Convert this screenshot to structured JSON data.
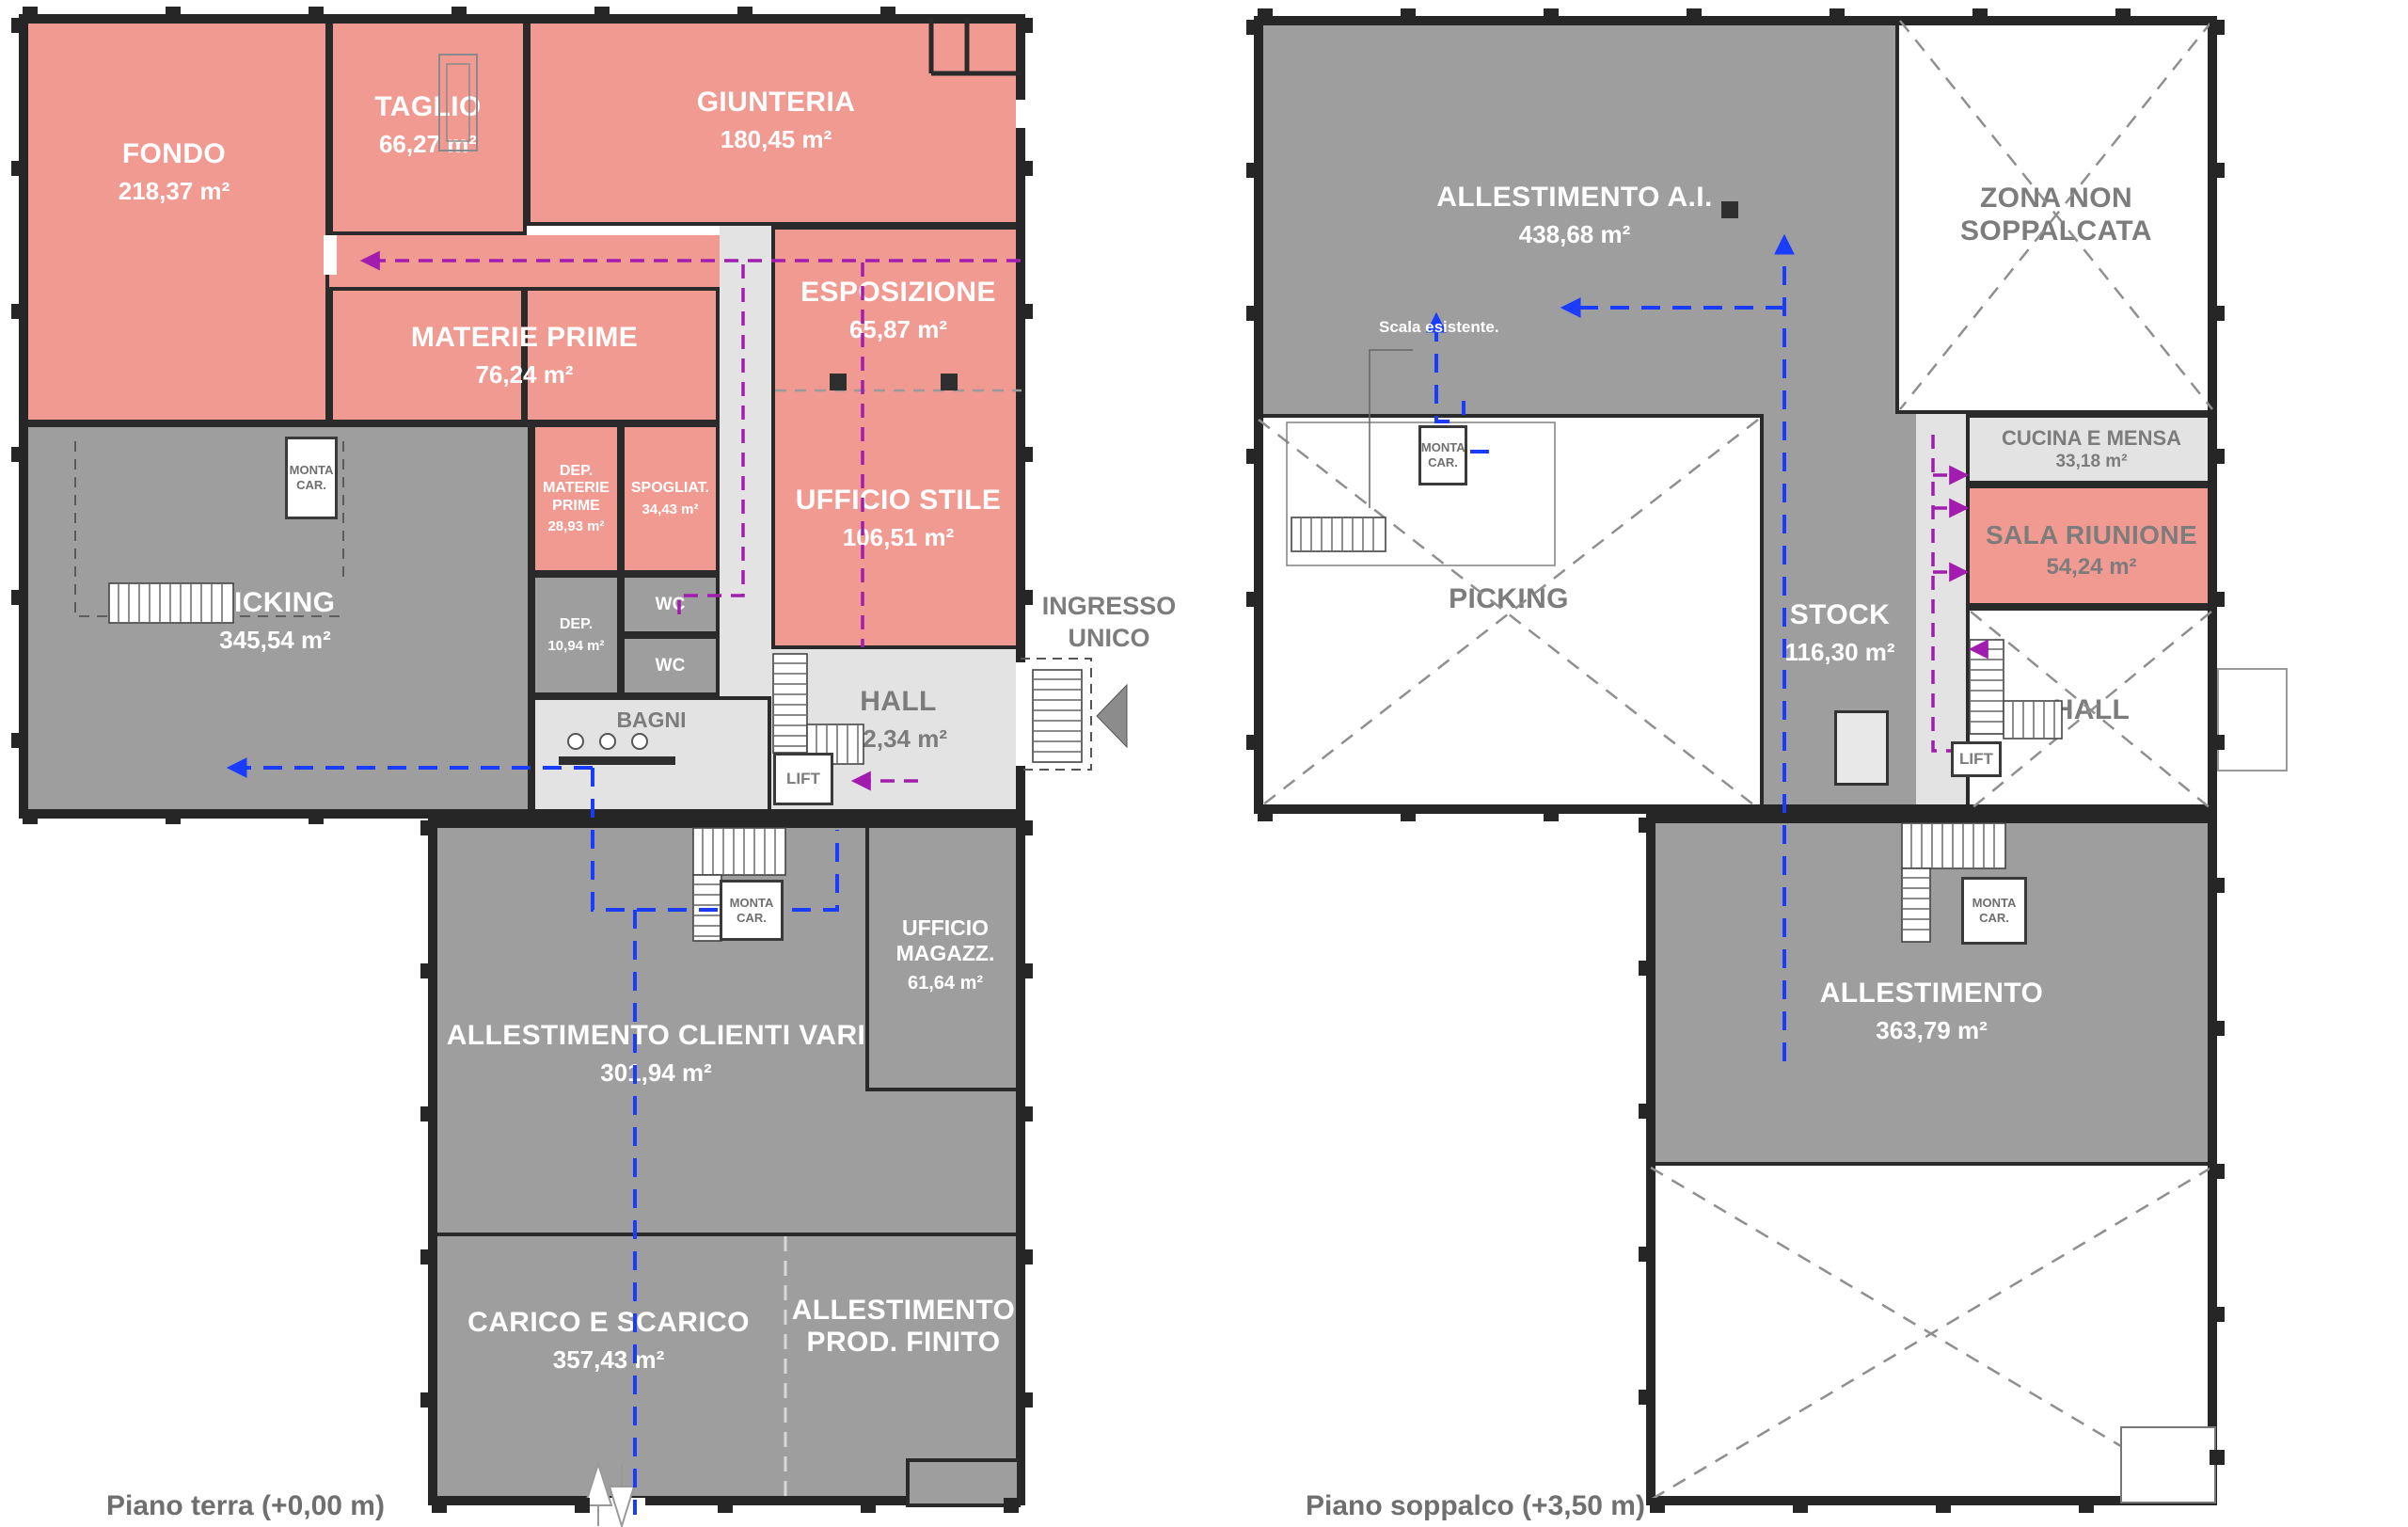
{
  "colors": {
    "room_pink": "#f19a92",
    "room_gray": "#9e9e9e",
    "room_light": "#e3e3e3",
    "wall": "#2a2a2a",
    "flow_blue": "#1a3cff",
    "flow_magenta": "#a21caf",
    "muted_text": "#7c7c7c"
  },
  "terra": {
    "caption": "Piano terra (+0,00 m)",
    "entrance_label": "INGRESSO UNICO",
    "rooms": {
      "fondo": {
        "name": "FONDO",
        "area": "218,37 m²"
      },
      "taglio": {
        "name": "TAGLIO",
        "area": "66,27 m²"
      },
      "giunteria": {
        "name": "GIUNTERIA",
        "area": "180,45 m²"
      },
      "esposizione": {
        "name": "ESPOSIZIONE",
        "area": "65,87 m²"
      },
      "materie_prime": {
        "name": "MATERIE PRIME",
        "area": "76,24 m²"
      },
      "ufficio_stile": {
        "name": "UFFICIO STILE",
        "area": "106,51 m²"
      },
      "picking": {
        "name": "PICKING",
        "area": "345,54 m²"
      },
      "dep_materie_prime": {
        "name": "DEP. MATERIE PRIME",
        "area": "28,93 m²"
      },
      "spogliatoio": {
        "name": "SPOGLIAT.",
        "area": "34,43 m²"
      },
      "deposito": {
        "name": "DEP.",
        "area": "10,94 m²"
      },
      "wc_1": {
        "name": "WC"
      },
      "wc_2": {
        "name": "WC"
      },
      "bagni": {
        "name": "BAGNI"
      },
      "hall": {
        "name": "HALL",
        "area": "82,34 m²"
      },
      "lift": {
        "name": "LIFT"
      },
      "monta_car_picking": {
        "name": "MONTA CAR."
      },
      "monta_car_hall": {
        "name": "MONTA CAR."
      },
      "ufficio_magazzino": {
        "name": "UFFICIO MAGAZZ.",
        "area": "61,64 m²"
      },
      "allestimento_clienti_vari": {
        "name": "ALLESTIMENTO CLIENTI VARI",
        "area": "301,94 m²"
      },
      "carico_scarico": {
        "name": "CARICO E SCARICO",
        "area": "357,43 m²"
      },
      "allestimento_prod_finito": {
        "name": "ALLESTIMENTO PROD. FINITO"
      }
    }
  },
  "soppalco": {
    "caption": "Piano soppalco (+3,50 m)",
    "stair_note": "Scala esistente.",
    "rooms": {
      "allestimento_ai": {
        "name": "ALLESTIMENTO A.I.",
        "area": "438,68 m²"
      },
      "zona_non_soppalcata": {
        "name": "ZONA NON SOPPALCATA"
      },
      "picking": {
        "name": "PICKING"
      },
      "stock": {
        "name": "STOCK",
        "area": "116,30 m²"
      },
      "cucina_mensa": {
        "name": "CUCINA E MENSA",
        "area": "33,18 m²"
      },
      "sala_riunione": {
        "name": "SALA RIUNIONE",
        "area": "54,24 m²"
      },
      "hall": {
        "name": "HALL"
      },
      "lift": {
        "name": "LIFT"
      },
      "monta_car_picking": {
        "name": "MONTA CAR."
      },
      "monta_car_allestimento": {
        "name": "MONTA CAR."
      },
      "allestimento": {
        "name": "ALLESTIMENTO",
        "area": "363,79 m²"
      }
    }
  }
}
